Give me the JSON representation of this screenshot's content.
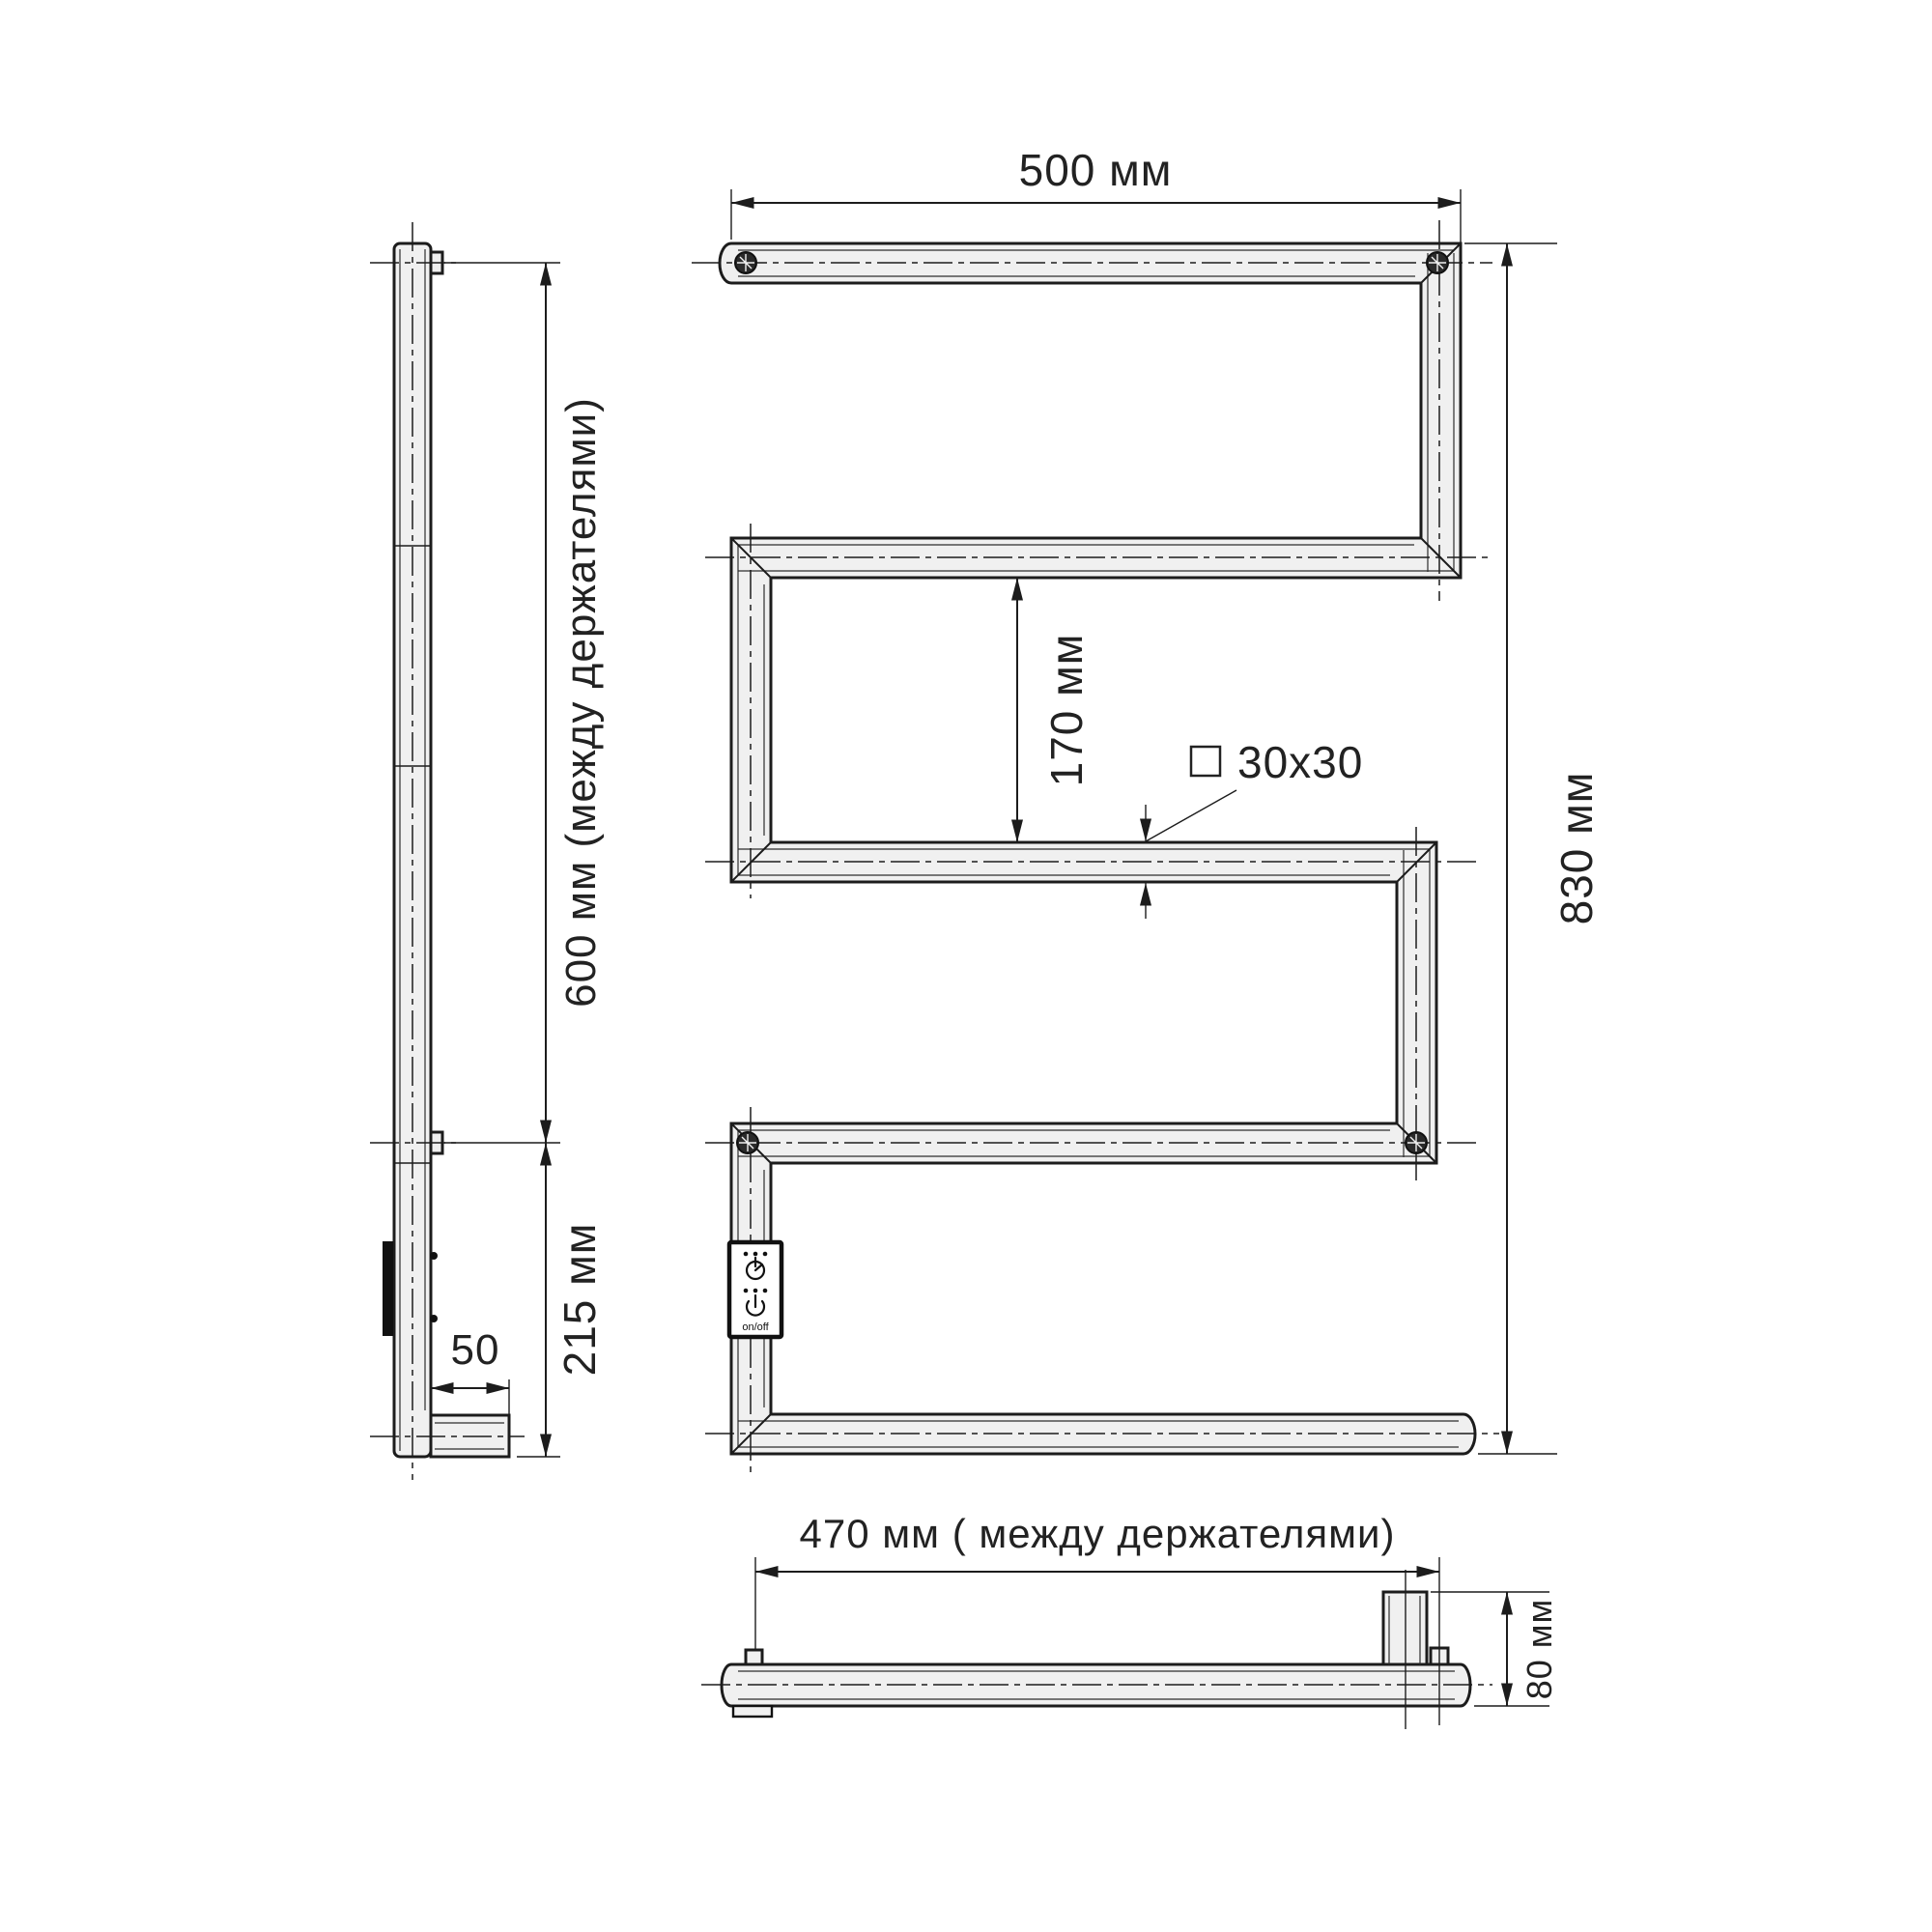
{
  "drawing": {
    "subject": "electric towel rail technical drawing, three views",
    "views": {
      "side": "side-view",
      "front": "front-view",
      "bottom": "bottom-view"
    }
  },
  "labels": {
    "width_top": "500 мм",
    "height_total": "830 мм",
    "bar_gap": "170 мм",
    "profile": "30x30",
    "holders_span_side": "600 мм (между держателями)",
    "bottom_section": "215 мм",
    "wall_offset": "50",
    "holders_span_bottom": "470 мм ( между держателями)",
    "bracket_height": "80 мм",
    "power_switch": "on/off"
  },
  "colors": {
    "line": "#1c1c1c",
    "tube_fill": "#f0f0f0",
    "background": "#ffffff",
    "panel_border": "#111111"
  }
}
